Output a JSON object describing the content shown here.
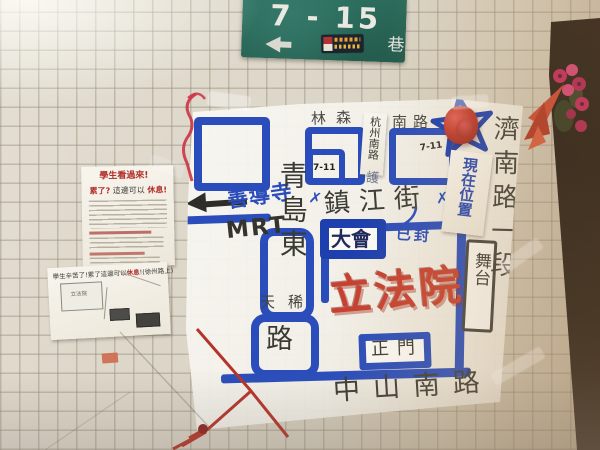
{
  "street_sign": {
    "number": "7 - 15",
    "lane": "巷"
  },
  "board": {
    "streets": {
      "linsen_a": "林森",
      "linsen_b": "南路",
      "tape_street": "杭州南路",
      "tape_under": "護",
      "zhenjiang": "鎮江街",
      "x_left": "✗",
      "x_right": "✗",
      "qingdao_vert": "青島東",
      "qingdao_lu": "路",
      "overpass": "天稀",
      "jinan_vert": "濟南路一段",
      "zhongshan": "中山南路"
    },
    "places": {
      "seven_eleven_a": "7-11",
      "seven_eleven_b": "7-11",
      "assembly": "大會",
      "sealed": "已封",
      "gate": "正門",
      "stage": "舞台",
      "ly": "立法院",
      "current": "現在位置",
      "mrt": "MRT",
      "shandao": "善導寺"
    }
  },
  "flyers": {
    "top": {
      "t1": "學生看過來!",
      "t2a": "累了?",
      "t2b": "這邊可以",
      "t2c": "休息!"
    },
    "bottom": {
      "title_a": "學生辛苦了!累了這邊可以",
      "title_b": "休息",
      "title_c": "!(徐州路上)",
      "map_label": "立法院"
    }
  },
  "colors": {
    "road_blue": "#2a4dbb",
    "marker_red": "#c8402f",
    "sign_green": "#2c6e5c",
    "board_white": "#f6f4ef"
  }
}
